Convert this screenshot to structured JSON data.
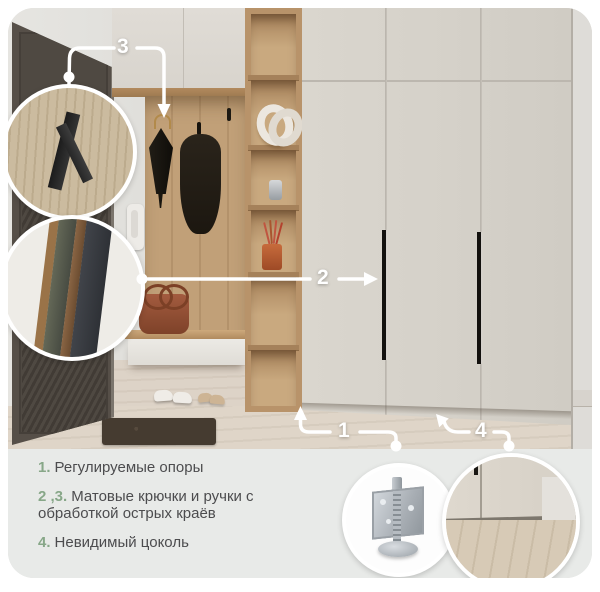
{
  "scene": {
    "description": "hallway with wardrobe",
    "colors": {
      "accent_green": "#87a788",
      "body_text": "#4c4c4e",
      "panel_bg": "#e8eae8",
      "callout_white": "#ffffff",
      "wardrobe": "#d5d1c9",
      "oak_wood": "#b8936a",
      "door_dark": "#4f4942",
      "handle_black": "#13110e"
    }
  },
  "callouts": [
    {
      "label": "1",
      "target": "adjustable-supports"
    },
    {
      "label": "2",
      "target": "door-handle"
    },
    {
      "label": "3",
      "target": "coat-hook"
    },
    {
      "label": "4",
      "target": "invisible-plinth"
    }
  ],
  "features": [
    {
      "num": "1.",
      "text": "Регулируемые опоры"
    },
    {
      "num": "2 ,3.",
      "text": "Матовые крючки и ручки с обработкой острых краёв"
    },
    {
      "num": "4.",
      "text": "Невидимый цоколь"
    }
  ],
  "insets": [
    {
      "name": "matte-hook-closeup"
    },
    {
      "name": "handle-edge-closeup"
    },
    {
      "name": "adjustable-support-leg"
    },
    {
      "name": "invisible-plinth-closeup"
    }
  ]
}
